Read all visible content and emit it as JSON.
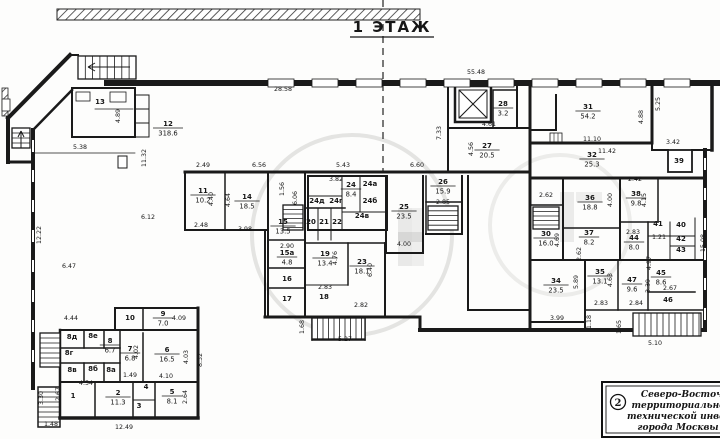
{
  "title": "1  ЭТАЖ",
  "stamp": {
    "number": "2",
    "lines": [
      "Северо-Восточно",
      "территориальное б",
      "технической инвентар",
      "города Москвы"
    ]
  },
  "floor_plan": {
    "rooms": [
      {
        "n": "12",
        "a": "318.6",
        "x": 168,
        "y": 126
      },
      {
        "n": "13",
        "a": null,
        "x": 100,
        "y": 104
      },
      {
        "n": "11",
        "a": "10.2",
        "x": 203,
        "y": 193
      },
      {
        "n": "14",
        "a": "18.5",
        "x": 247,
        "y": 199
      },
      {
        "n": "15",
        "a": "13.5",
        "x": 283,
        "y": 224
      },
      {
        "n": "15а",
        "a": "4.8",
        "x": 287,
        "y": 255
      },
      {
        "n": "16",
        "a": null,
        "x": 287,
        "y": 281
      },
      {
        "n": "17",
        "a": null,
        "x": 287,
        "y": 301
      },
      {
        "n": "18",
        "a": null,
        "x": 324,
        "y": 299
      },
      {
        "n": "19",
        "a": "13.4",
        "x": 325,
        "y": 256
      },
      {
        "n": "20",
        "a": null,
        "x": 311,
        "y": 224
      },
      {
        "n": "21",
        "a": null,
        "x": 324,
        "y": 224
      },
      {
        "n": "22",
        "a": null,
        "x": 337,
        "y": 224
      },
      {
        "n": "23",
        "a": "18.1",
        "x": 362,
        "y": 264
      },
      {
        "n": "24",
        "a": "8.4",
        "x": 351,
        "y": 187
      },
      {
        "n": "24а",
        "a": null,
        "x": 370,
        "y": 186
      },
      {
        "n": "24б",
        "a": null,
        "x": 370,
        "y": 203
      },
      {
        "n": "24в",
        "a": null,
        "x": 362,
        "y": 218
      },
      {
        "n": "24г",
        "a": null,
        "x": 336,
        "y": 203
      },
      {
        "n": "24д",
        "a": null,
        "x": 317,
        "y": 203
      },
      {
        "n": "25",
        "a": "23.5",
        "x": 404,
        "y": 209
      },
      {
        "n": "26",
        "a": "15.9",
        "x": 443,
        "y": 184
      },
      {
        "n": "27",
        "a": "20.5",
        "x": 487,
        "y": 148
      },
      {
        "n": "28",
        "a": "3.2",
        "x": 503,
        "y": 106
      },
      {
        "n": "30",
        "a": "16.0",
        "x": 546,
        "y": 236
      },
      {
        "n": "31",
        "a": "54.2",
        "x": 588,
        "y": 109
      },
      {
        "n": "32",
        "a": "25.3",
        "x": 592,
        "y": 157
      },
      {
        "n": "34",
        "a": "23.5",
        "x": 556,
        "y": 283
      },
      {
        "n": "35",
        "a": "13.1",
        "x": 600,
        "y": 274
      },
      {
        "n": "36",
        "a": "18.8",
        "x": 590,
        "y": 200
      },
      {
        "n": "37",
        "a": "8.2",
        "x": 589,
        "y": 235
      },
      {
        "n": "38",
        "a": "9.8",
        "x": 636,
        "y": 196
      },
      {
        "n": "39",
        "a": null,
        "x": 679,
        "y": 163
      },
      {
        "n": "40",
        "a": null,
        "x": 681,
        "y": 227
      },
      {
        "n": "41",
        "a": null,
        "x": 658,
        "y": 226
      },
      {
        "n": "42",
        "a": null,
        "x": 681,
        "y": 241
      },
      {
        "n": "43",
        "a": null,
        "x": 681,
        "y": 252
      },
      {
        "n": "44",
        "a": "8.0",
        "x": 634,
        "y": 240
      },
      {
        "n": "45",
        "a": "8.6",
        "x": 661,
        "y": 275
      },
      {
        "n": "46",
        "a": null,
        "x": 668,
        "y": 302
      },
      {
        "n": "47",
        "a": "9.6",
        "x": 632,
        "y": 282
      },
      {
        "n": "1",
        "a": null,
        "x": 73,
        "y": 398
      },
      {
        "n": "2",
        "a": "11.3",
        "x": 118,
        "y": 395
      },
      {
        "n": "3",
        "a": null,
        "x": 139,
        "y": 408
      },
      {
        "n": "4",
        "a": null,
        "x": 146,
        "y": 389
      },
      {
        "n": "5",
        "a": "8.1",
        "x": 172,
        "y": 394
      },
      {
        "n": "6",
        "a": "16.5",
        "x": 167,
        "y": 352
      },
      {
        "n": "7",
        "a": "6.8",
        "x": 130,
        "y": 351
      },
      {
        "n": "8",
        "a": "6.7",
        "x": 110,
        "y": 343
      },
      {
        "n": "8а",
        "a": null,
        "x": 111,
        "y": 372
      },
      {
        "n": "8б",
        "a": null,
        "x": 93,
        "y": 371
      },
      {
        "n": "8в",
        "a": null,
        "x": 72,
        "y": 372
      },
      {
        "n": "8г",
        "a": null,
        "x": 69,
        "y": 355
      },
      {
        "n": "8д",
        "a": null,
        "x": 72,
        "y": 339
      },
      {
        "n": "8е",
        "a": null,
        "x": 93,
        "y": 338
      },
      {
        "n": "9",
        "a": "7.0",
        "x": 163,
        "y": 316
      },
      {
        "n": "10",
        "a": null,
        "x": 130,
        "y": 320
      }
    ],
    "dimensions": [
      {
        "t": "28.58",
        "x": 283,
        "y": 91
      },
      {
        "t": "55.48",
        "x": 476,
        "y": 74
      },
      {
        "t": "5.38",
        "x": 80,
        "y": 149
      },
      {
        "t": "11.32",
        "x": 146,
        "y": 158,
        "r": 90
      },
      {
        "t": "12.22",
        "x": 41,
        "y": 235,
        "r": 90
      },
      {
        "t": "6.47",
        "x": 69,
        "y": 268
      },
      {
        "t": "6.12",
        "x": 148,
        "y": 219
      },
      {
        "t": "4.44",
        "x": 71,
        "y": 320
      },
      {
        "t": "2.49",
        "x": 203,
        "y": 167
      },
      {
        "t": "6.56",
        "x": 259,
        "y": 167
      },
      {
        "t": "5.43",
        "x": 343,
        "y": 167
      },
      {
        "t": "3.82",
        "x": 336,
        "y": 181
      },
      {
        "t": "6.60",
        "x": 417,
        "y": 167
      },
      {
        "t": "4.40",
        "x": 213,
        "y": 199,
        "r": 90
      },
      {
        "t": "4.64",
        "x": 230,
        "y": 200,
        "r": 90
      },
      {
        "t": "2.48",
        "x": 201,
        "y": 227
      },
      {
        "t": "3.98",
        "x": 245,
        "y": 231
      },
      {
        "t": "2.90",
        "x": 287,
        "y": 248
      },
      {
        "t": "1.56",
        "x": 284,
        "y": 189,
        "r": 90
      },
      {
        "t": "6.06",
        "x": 297,
        "y": 198,
        "r": 90
      },
      {
        "t": "1.49",
        "x": 130,
        "y": 377
      },
      {
        "t": "4.02",
        "x": 138,
        "y": 352,
        "r": 90
      },
      {
        "t": "4.10",
        "x": 166,
        "y": 378
      },
      {
        "t": "4.03",
        "x": 188,
        "y": 357,
        "r": 90
      },
      {
        "t": "8.32",
        "x": 202,
        "y": 360,
        "r": 90
      },
      {
        "t": "2.64",
        "x": 187,
        "y": 397,
        "r": 90
      },
      {
        "t": "4.54",
        "x": 86,
        "y": 385
      },
      {
        "t": "2.67",
        "x": 60,
        "y": 394,
        "r": 90
      },
      {
        "t": "3.30",
        "x": 43,
        "y": 398,
        "r": 90
      },
      {
        "t": "1.48",
        "x": 51,
        "y": 426
      },
      {
        "t": "12.49",
        "x": 124,
        "y": 429
      },
      {
        "t": "4.09",
        "x": 179,
        "y": 320
      },
      {
        "t": "5.27",
        "x": 345,
        "y": 341
      },
      {
        "t": "1.68",
        "x": 304,
        "y": 327,
        "r": 90
      },
      {
        "t": "2.82",
        "x": 361,
        "y": 307
      },
      {
        "t": "2.83",
        "x": 325,
        "y": 289
      },
      {
        "t": "4.76",
        "x": 337,
        "y": 258,
        "r": 90
      },
      {
        "t": "6.40",
        "x": 372,
        "y": 270,
        "r": 90
      },
      {
        "t": "4.00",
        "x": 404,
        "y": 246
      },
      {
        "t": "2.85",
        "x": 443,
        "y": 204
      },
      {
        "t": "7.33",
        "x": 441,
        "y": 133,
        "r": 90
      },
      {
        "t": "4.61",
        "x": 489,
        "y": 126
      },
      {
        "t": "4.56",
        "x": 473,
        "y": 149,
        "r": 90
      },
      {
        "t": "11.10",
        "x": 592,
        "y": 141
      },
      {
        "t": "11.42",
        "x": 607,
        "y": 153
      },
      {
        "t": "3.42",
        "x": 673,
        "y": 144
      },
      {
        "t": "5.25",
        "x": 660,
        "y": 104,
        "r": 90
      },
      {
        "t": "4.88",
        "x": 643,
        "y": 117,
        "r": 90
      },
      {
        "t": "4.89",
        "x": 120,
        "y": 116,
        "r": 90
      },
      {
        "t": "2.42",
        "x": 635,
        "y": 181
      },
      {
        "t": "4.00",
        "x": 612,
        "y": 200,
        "r": 90
      },
      {
        "t": "4.15",
        "x": 646,
        "y": 200,
        "r": 90
      },
      {
        "t": "2.62",
        "x": 546,
        "y": 197
      },
      {
        "t": "4.69",
        "x": 559,
        "y": 240,
        "r": 90
      },
      {
        "t": "2.83",
        "x": 601,
        "y": 305
      },
      {
        "t": "2.84",
        "x": 636,
        "y": 305
      },
      {
        "t": "2.83",
        "x": 633,
        "y": 234
      },
      {
        "t": "2.62",
        "x": 581,
        "y": 254,
        "r": 90
      },
      {
        "t": "3.39",
        "x": 650,
        "y": 286,
        "r": 90
      },
      {
        "t": "4.63",
        "x": 612,
        "y": 280,
        "r": 90
      },
      {
        "t": "5.89",
        "x": 578,
        "y": 282,
        "r": 90
      },
      {
        "t": "3.99",
        "x": 557,
        "y": 320
      },
      {
        "t": "1.18",
        "x": 591,
        "y": 322,
        "r": 90
      },
      {
        "t": "1.65",
        "x": 621,
        "y": 327,
        "r": 90
      },
      {
        "t": "5.10",
        "x": 655,
        "y": 345
      },
      {
        "t": "1.21",
        "x": 659,
        "y": 239
      },
      {
        "t": "4.97",
        "x": 651,
        "y": 263,
        "r": 90
      },
      {
        "t": "2.67",
        "x": 670,
        "y": 290
      },
      {
        "t": "15.08",
        "x": 705,
        "y": 243,
        "r": 90
      }
    ]
  }
}
